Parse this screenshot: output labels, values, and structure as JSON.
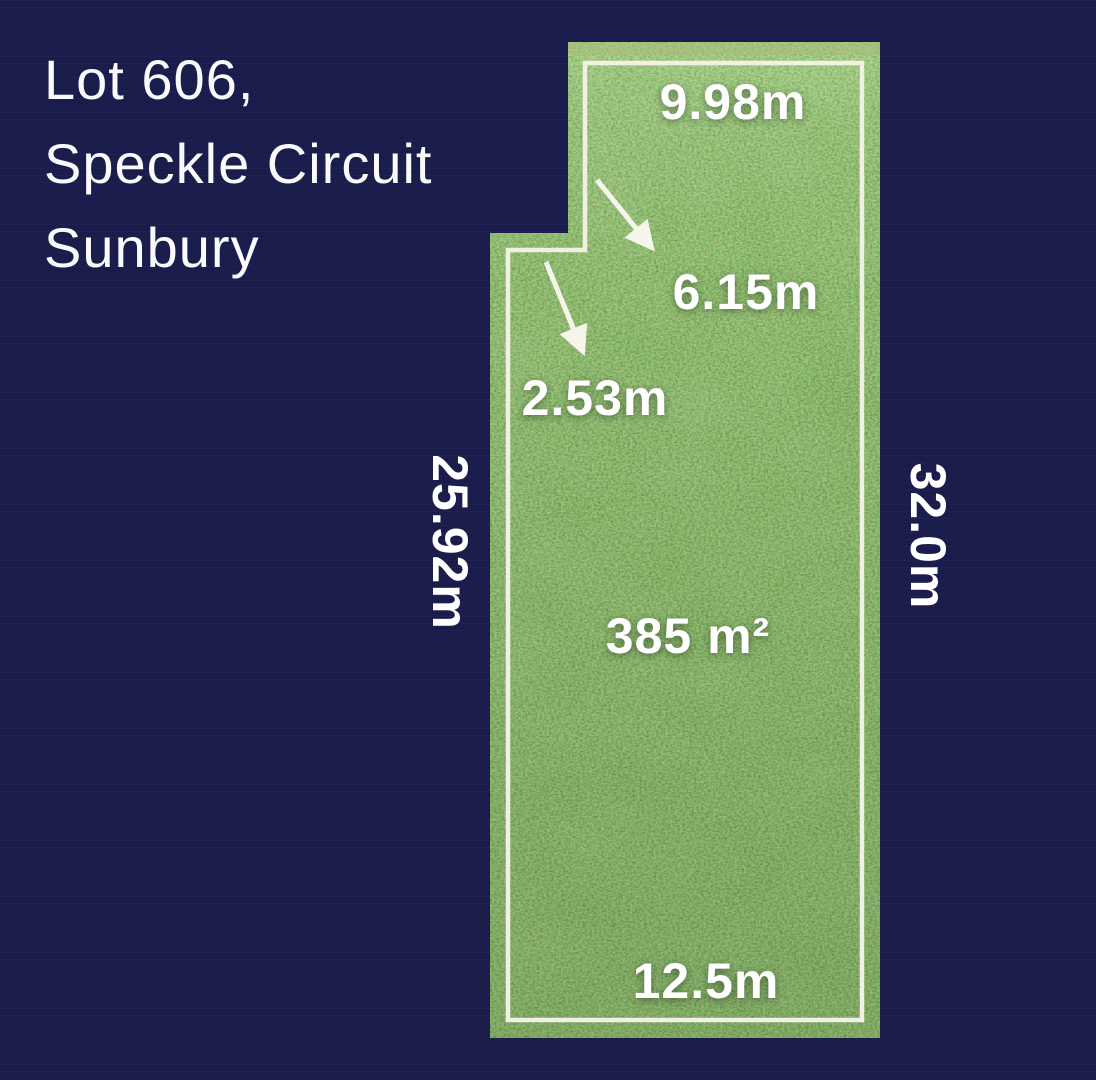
{
  "title": {
    "line1": "Lot 606,",
    "line2": "Speckle Circuit",
    "line3": "Sunbury"
  },
  "lot": {
    "area": "385 m²",
    "dimensions": {
      "top": "9.98m",
      "upper_left_side": "6.15m",
      "notch_step": "2.53m",
      "left_side": "25.92m",
      "right_side": "32.0m",
      "bottom": "12.5m"
    }
  },
  "colors": {
    "background": "#1a1d4b",
    "boundary_line": "#f2f0e4",
    "label_text": "#ffffff",
    "grass_base": "#3b8026"
  }
}
